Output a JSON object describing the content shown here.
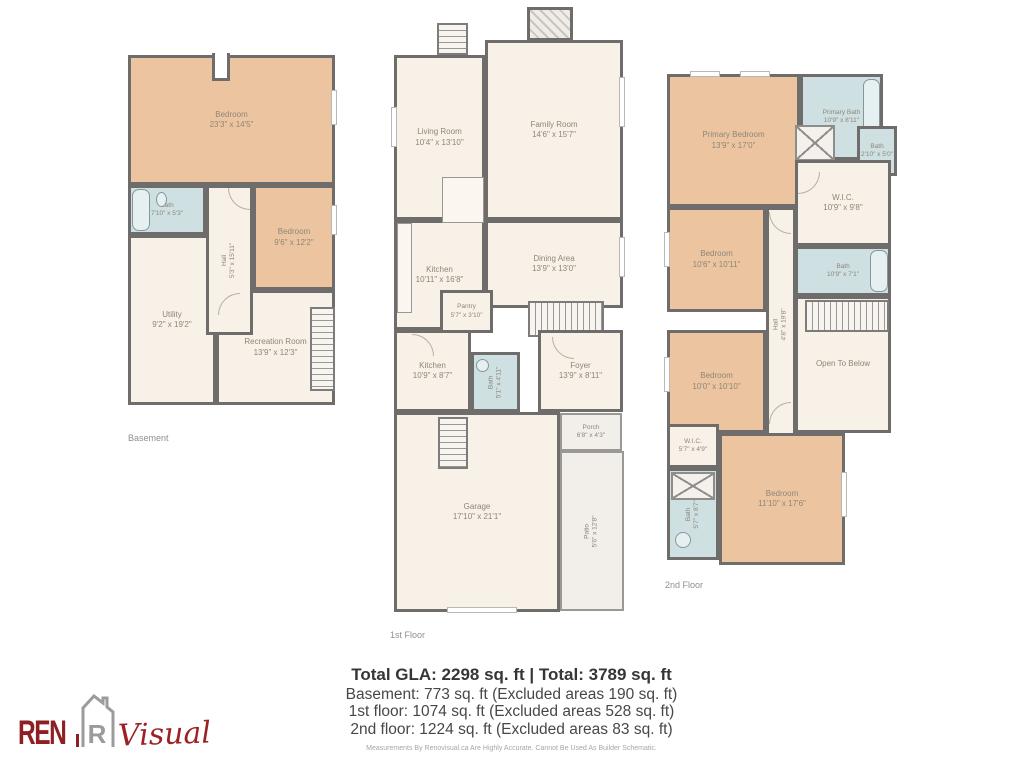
{
  "floors": [
    {
      "caption": "Basement",
      "rooms": {
        "bedroom_large": {
          "label": "Bedroom",
          "dims": "23'3\" x 14'5\""
        },
        "bath": {
          "label": "Bath",
          "dims": "7'10\" x 5'3\""
        },
        "hall": {
          "label": "Hall",
          "dims": "5'3\" x 15'11\""
        },
        "bedroom": {
          "label": "Bedroom",
          "dims": "9'6\" x 12'2\""
        },
        "utility": {
          "label": "Utility",
          "dims": "9'2\" x 19'2\""
        },
        "recreation": {
          "label": "Recreation Room",
          "dims": "13'9\" x 12'3\""
        }
      }
    },
    {
      "caption": "1st Floor",
      "rooms": {
        "living": {
          "label": "Living Room",
          "dims": "10'4\" x 13'10\""
        },
        "family": {
          "label": "Family Room",
          "dims": "14'6\" x 15'7\""
        },
        "kitchen": {
          "label": "Kitchen",
          "dims": "10'11\" x 16'8\""
        },
        "dining": {
          "label": "Dining Area",
          "dims": "13'9\" x 13'0\""
        },
        "pantry": {
          "label": "Pantry",
          "dims": "5'7\" x 3'10\""
        },
        "kitchen2": {
          "label": "Kitchen",
          "dims": "10'9\" x 8'7\""
        },
        "bath": {
          "label": "Bath",
          "dims": "5'1\" x 4'11\""
        },
        "foyer": {
          "label": "Foyer",
          "dims": "13'9\" x 8'11\""
        },
        "garage": {
          "label": "Garage",
          "dims": "17'10\" x 21'1\""
        },
        "porch": {
          "label": "Porch",
          "dims": "6'8\" x 4'3\""
        },
        "patio": {
          "label": "Patio",
          "dims": "5'6\" x 12'8\""
        }
      }
    },
    {
      "caption": "2nd Floor",
      "rooms": {
        "primary_bedroom": {
          "label": "Primary Bedroom",
          "dims": "13'9\" x 17'0\""
        },
        "primary_bath": {
          "label": "Primary Bath",
          "dims": "10'9\" x 8'11\""
        },
        "bath_small": {
          "label": "Bath",
          "dims": "2'10\" x 5'0\""
        },
        "wic": {
          "label": "W.I.C.",
          "dims": "10'9\" x 9'8\""
        },
        "bedroom2": {
          "label": "Bedroom",
          "dims": "10'6\" x 10'11\""
        },
        "bath2": {
          "label": "Bath",
          "dims": "10'9\" x 7'1\""
        },
        "hall": {
          "label": "Hall",
          "dims": "4'8\" x 19'8\""
        },
        "bedroom3": {
          "label": "Bedroom",
          "dims": "10'0\" x 10'10\""
        },
        "open_below": {
          "label": "Open To Below",
          "dims": ""
        },
        "wic_small": {
          "label": "W.I.C.",
          "dims": "5'7\" x 4'9\""
        },
        "bath3": {
          "label": "Bath",
          "dims": "5'7\" x 8'7\""
        },
        "bedroom4": {
          "label": "Bedroom",
          "dims": "11'10\" x 17'6\""
        }
      }
    }
  ],
  "summary": {
    "title": "Total GLA: 2298 sq. ft | Total: 3789 sq. ft",
    "lines": [
      "Basement: 773 sq. ft (Excluded areas 190 sq. ft)",
      "1st floor: 1074 sq. ft (Excluded areas 528 sq. ft)",
      "2nd floor: 1224 sq. ft (Excluded areas 83 sq. ft)"
    ],
    "disclaimer": "Measurements By Renovisual.ca Are Highly Accurate. Cannot Be Used As Builder Schematic."
  },
  "logo": {
    "ren": "REN",
    "icon_letter": "R",
    "visual": "Visual"
  },
  "colors": {
    "wall": "#6e6d6b",
    "bedroom_fill": "#ecc5a0",
    "bath_fill": "#cfe0e2",
    "room_fill": "#f8f1e8",
    "outdoor_fill": "#f2efeb",
    "label_text": "#8d8678",
    "summary_text": "#363636",
    "logo_red": "#8e2023",
    "logo_gray": "#9b9b9d"
  }
}
